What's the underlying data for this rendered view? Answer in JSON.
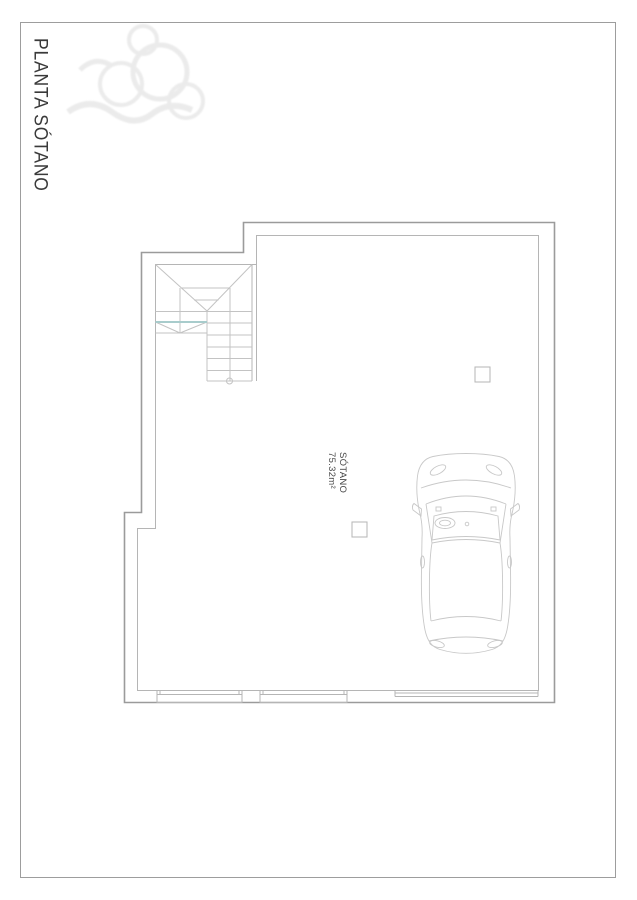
{
  "page": {
    "title": "PLANTA SÓTANO"
  },
  "room": {
    "name": "SÓTANO",
    "area": "75.32m²"
  },
  "colors": {
    "border": "#9d9d9d",
    "wall_outer": "#9b9b9b",
    "wall_inner": "#b5b5b5",
    "detail": "#c3c3c3",
    "car": "#c8c8c8",
    "section_cut": "#a8cccc",
    "watermark": "#e9e9e9",
    "text": "#3a3a3a",
    "label": "#4a4a4a",
    "background": "#ffffff"
  }
}
